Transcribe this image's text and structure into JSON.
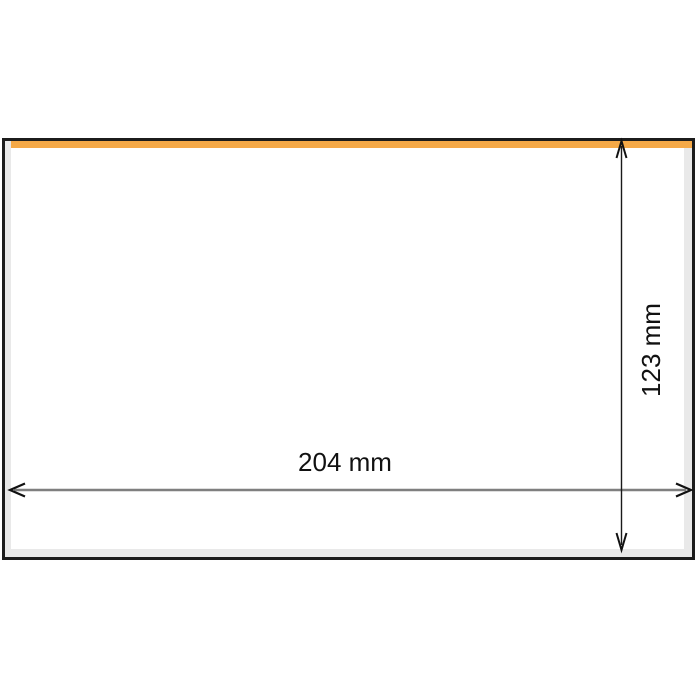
{
  "diagram": {
    "width_label": "204 mm",
    "height_label": "123 mm",
    "colors": {
      "accent_strip": "#f5a947",
      "frame_border": "#1c1c1c",
      "mat": "#e9e9e9",
      "interior": "#ffffff",
      "width_arrow_line": "#7f7f7f",
      "height_arrow_line": "#1a1a1a",
      "arrowhead": "#111111",
      "label_text": "#111111"
    }
  }
}
